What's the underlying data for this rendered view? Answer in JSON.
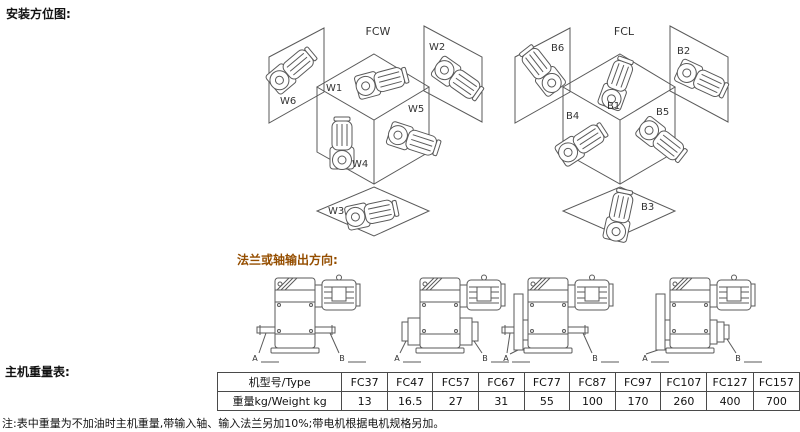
{
  "titles": {
    "mounting": "安装方位图:",
    "output_direction": "法兰或轴输出方向:",
    "weight_table": "主机重量表:"
  },
  "note": "注:表中重量为不加油时主机重量,带输入轴、输入法兰另加10%;带电机根据电机规格另加。",
  "diagrams": {
    "fcw": {
      "title": "FCW",
      "labels": [
        "W1",
        "W2",
        "W3",
        "W4",
        "W5",
        "W6"
      ]
    },
    "fcl": {
      "title": "FCL",
      "labels": [
        "B1",
        "B2",
        "B3",
        "B4",
        "B5",
        "B6"
      ]
    }
  },
  "output_drawings": {
    "shaft_label_a": "A",
    "shaft_label_b": "B"
  },
  "weight_table": {
    "type_row_label": "机型号/Type",
    "weight_row_label": "重量kg/Weight kg",
    "models": [
      "FC37",
      "FC47",
      "FC57",
      "FC67",
      "FC77",
      "FC87",
      "FC97",
      "FC107",
      "FC127",
      "FC157"
    ],
    "weights": [
      "13",
      "16.5",
      "27",
      "31",
      "55",
      "100",
      "170",
      "260",
      "400",
      "700"
    ]
  },
  "colors": {
    "accent_heading": "#954e00",
    "line_art": "#5a5a5a",
    "text": "#111111",
    "table_border": "#4a4a4a",
    "background": "#ffffff"
  }
}
